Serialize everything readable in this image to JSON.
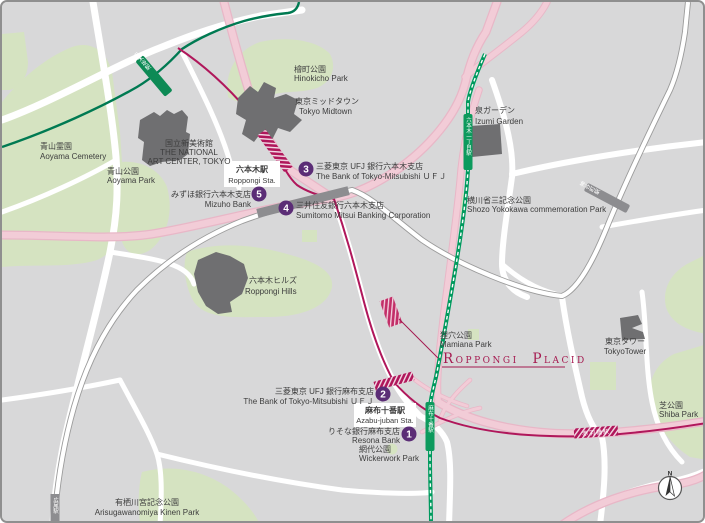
{
  "map": {
    "places": {
      "aoyama_cemetery": {
        "ja": "青山霊園",
        "en": "Aoyama Cemetery"
      },
      "aoyama_park": {
        "ja": "青山公園",
        "en": "Aoyama Park"
      },
      "art_center": {
        "ja": "国立新美術館",
        "en1": "THE NATIONAL",
        "en2": "ART CENTER, TOKYO"
      },
      "hinokicho_park": {
        "ja": "檜町公園",
        "en": "Hinokicho Park"
      },
      "tokyo_midtown": {
        "ja": "東京ミッドタウン",
        "en": "Tokyo Midtown"
      },
      "izumi_garden": {
        "ja": "泉ガーデン",
        "en": "Izumi Garden"
      },
      "yokokawa_park": {
        "ja": "横川省三記念公園",
        "en": "Shozo Yokokawa commemoration Park"
      },
      "roppongi_hills": {
        "ja": "六本木ヒルズ",
        "en": "Roppongi Hills"
      },
      "mamiana_park": {
        "ja": "狸穴公園",
        "en": "Mamiana Park"
      },
      "tokyo_tower": {
        "ja": "東京タワー",
        "en": "TokyoTower"
      },
      "shiba_park": {
        "ja": "芝公園",
        "en": "Shiba Park"
      },
      "wickerwork_park": {
        "ja": "網代公園",
        "en": "Wickerwork Park"
      },
      "arisugawa_park": {
        "ja": "有栖川宮記念公園",
        "en": "Arisugawanomiya Kinen Park"
      }
    },
    "stations": {
      "roppongi": {
        "ja": "六本木駅",
        "en": "Roppongi Sta."
      },
      "azabujuban": {
        "ja": "麻布十番駅",
        "en": "Azabu-juban Sta."
      },
      "nogizaka": {
        "ja": "乃木坂駅"
      },
      "roppongi_itchome": {
        "ja": "六本木一丁目駅"
      },
      "kamiyacho": {
        "ja": "神谷町駅"
      },
      "hiroo": {
        "ja": "広尾駅"
      },
      "akabanebashi": {
        "ja": "赤羽橋駅"
      }
    },
    "banks": [
      {
        "no": "1",
        "ja": "りそな銀行麻布支店",
        "en": "Resona Bank"
      },
      {
        "no": "2",
        "ja": "三菱東京 UFJ 銀行麻布支店",
        "en": "The Bank of Tokyo-Mitsubishi ＵＦＪ"
      },
      {
        "no": "3",
        "ja": "三菱東京 UFJ 銀行六本木支店",
        "en": "The Bank of Tokyo-Mitsubishi ＵＦＪ"
      },
      {
        "no": "4",
        "ja": "三井住友銀行六本木支店",
        "en": "Sumitomo Mitsui Banking Corporation"
      },
      {
        "no": "5",
        "ja": "みずほ銀行六本木支店",
        "en": "Mizuho Bank"
      }
    ],
    "venue": {
      "name": "Roppongi Placid"
    },
    "compass": {
      "label": "N"
    },
    "colors": {
      "background": "#d8d8d9",
      "park_green": "#d5e3c1",
      "building_gray": "#6f6f71",
      "road_pink": "#f2ccd7",
      "oedo_magenta": "#b0175b",
      "subway_green": "#009a5e",
      "chiyoda_green": "#007a52",
      "hibiya_gray": "#9b9b9b",
      "marker_purple": "#5b2d76",
      "venue_accent": "#a51a50"
    }
  }
}
